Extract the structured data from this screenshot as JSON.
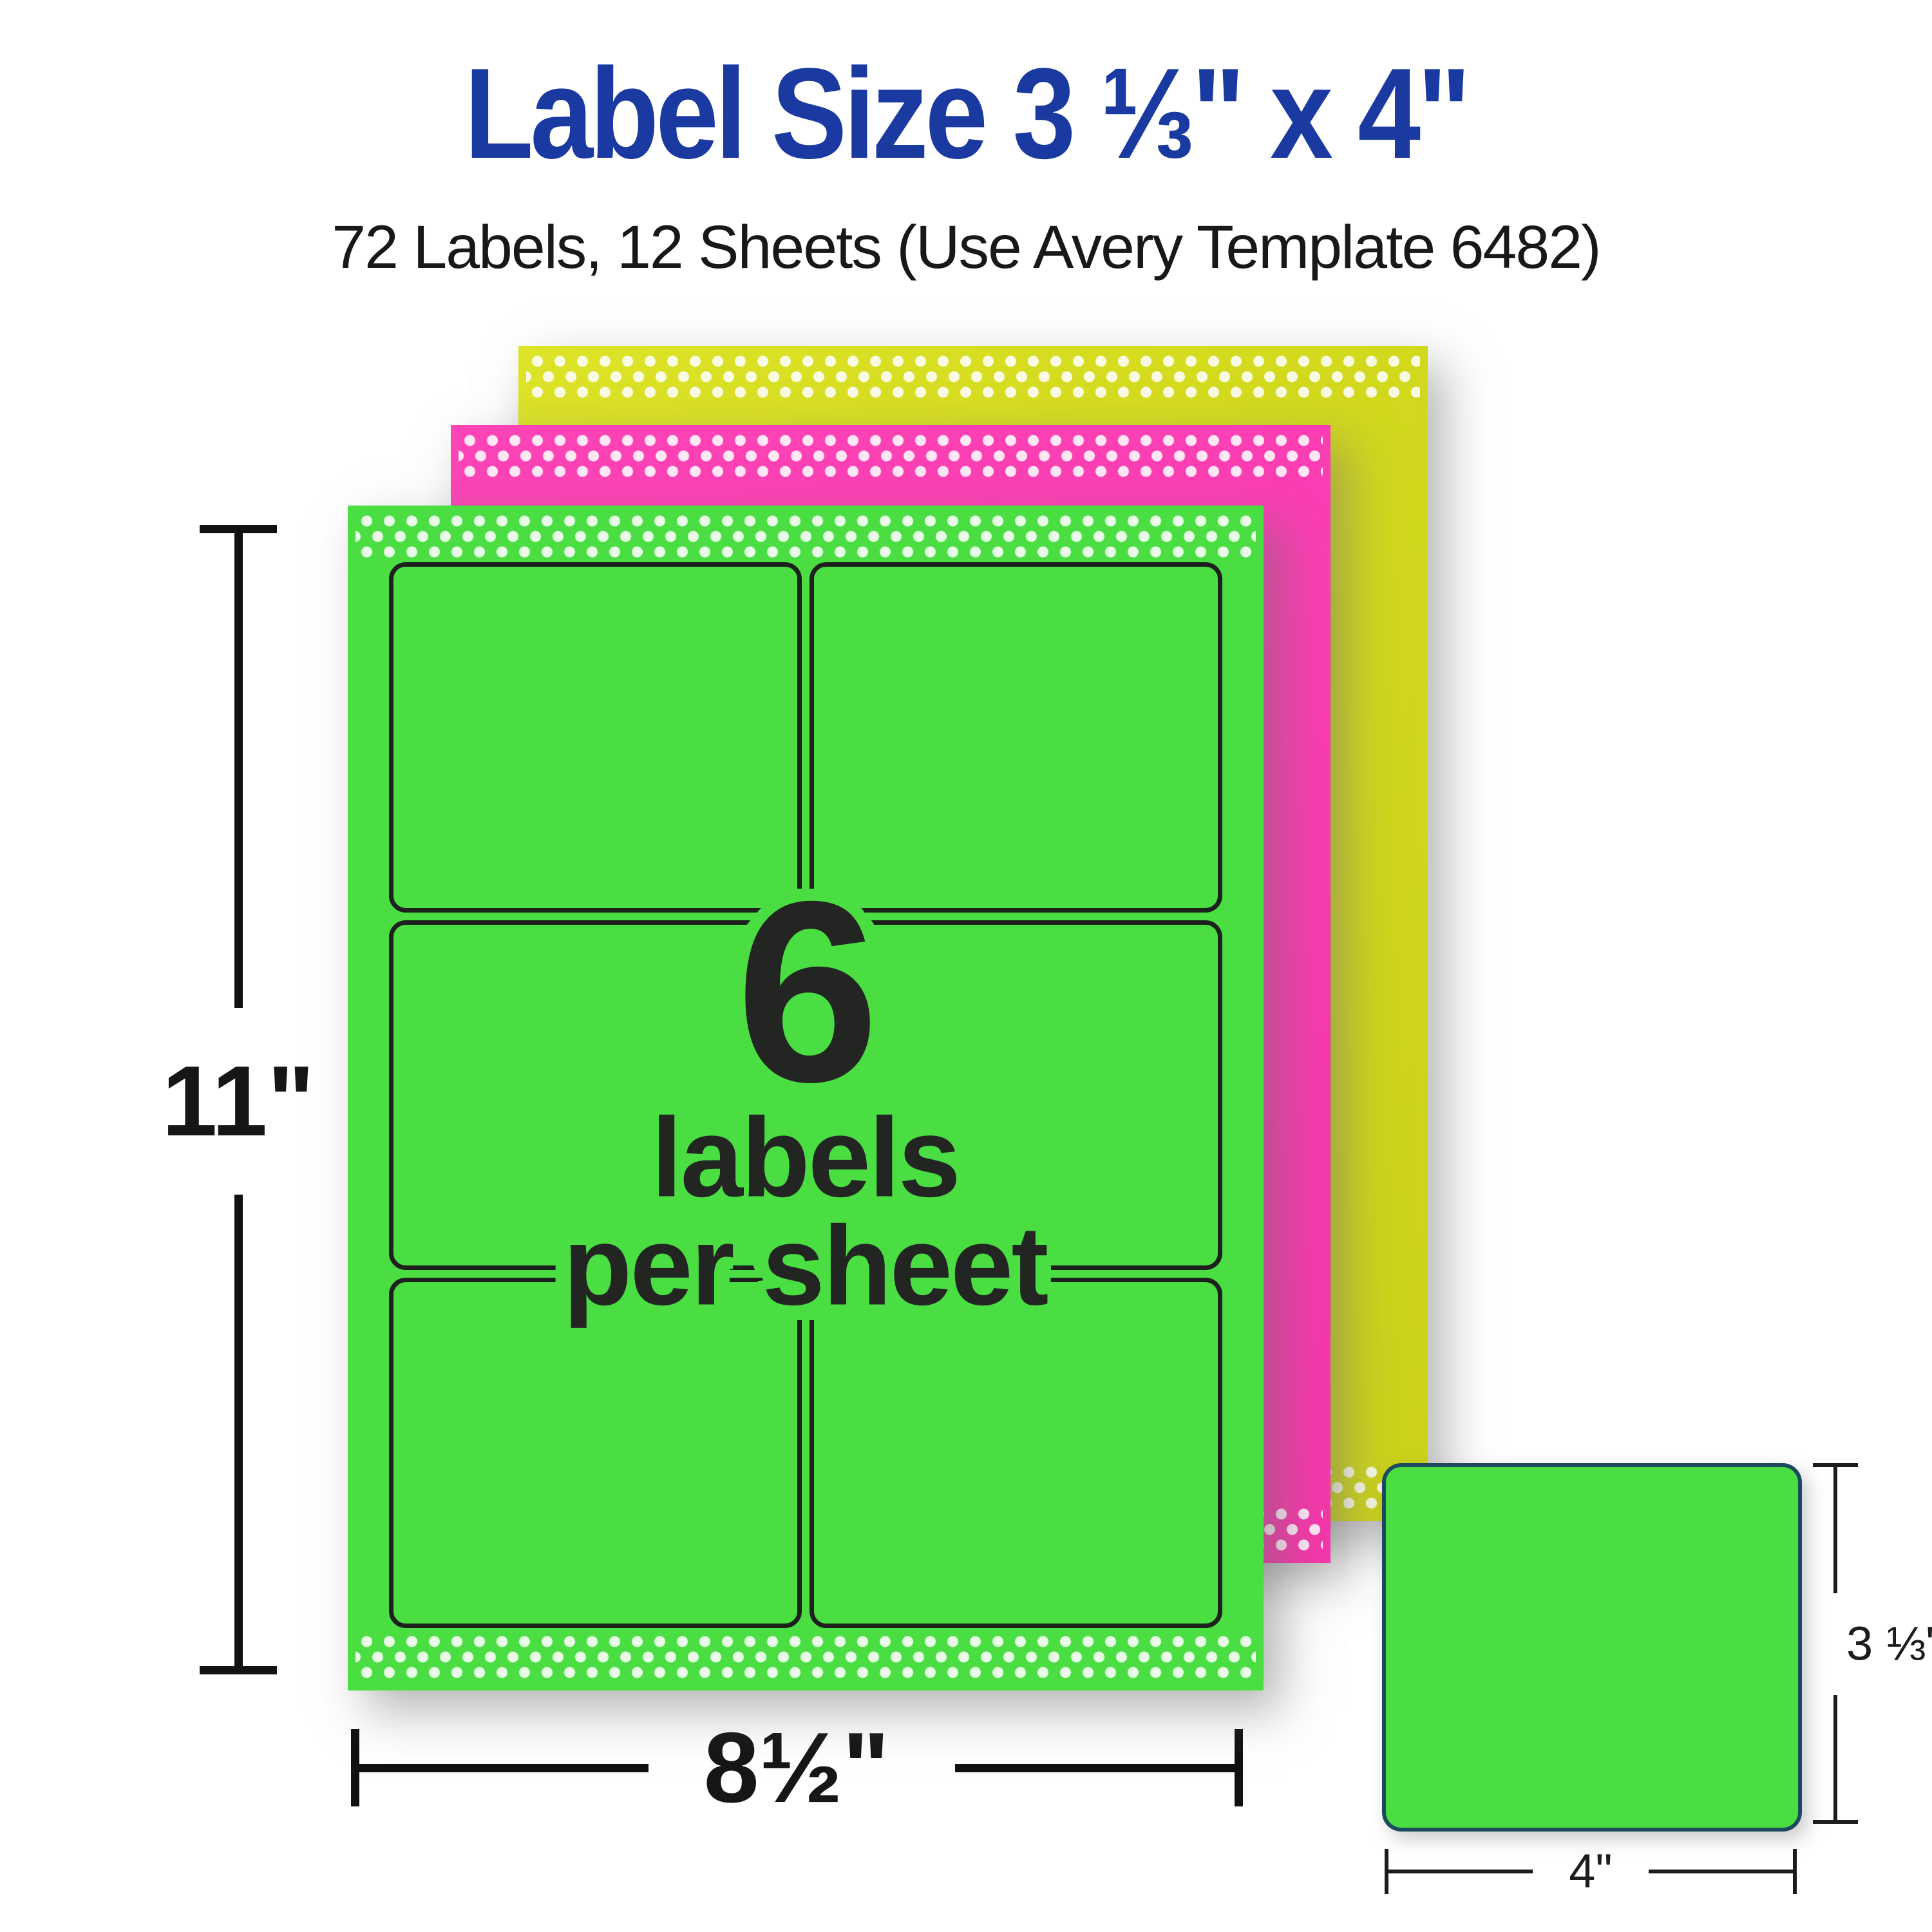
{
  "header": {
    "title": "Label Size 3 ⅓\" x 4\"",
    "subtitle": "72 Labels, 12 Sheets (Use Avery Template 6482)"
  },
  "overlay": {
    "count": "6",
    "line1": "labels",
    "line2": "per sheet"
  },
  "dims": {
    "sheet_height": "11\"",
    "sheet_width": "8½\"",
    "label_height": "3 ⅓\"",
    "label_width": "4\""
  },
  "sheets": [
    {
      "name": "yellow-sheet",
      "color": "#d4db1e",
      "position": "back"
    },
    {
      "name": "pink-sheet",
      "color": "#fb3eb3",
      "position": "middle"
    },
    {
      "name": "green-sheet",
      "color": "#4ade43",
      "position": "front",
      "labels_per_sheet": 6,
      "grid": {
        "cols": 2,
        "rows": 3
      }
    }
  ],
  "colors": {
    "title_blue": "#1a3aa1",
    "neon_green": "#4ade43",
    "neon_pink": "#fb3eb3",
    "neon_yellow": "#d4db1e",
    "grid_outline": "#1d201d",
    "swatch_border": "#1b4a5e",
    "text_dark": "#232523",
    "dot_white": "rgba(255,255,255,0.87)"
  }
}
